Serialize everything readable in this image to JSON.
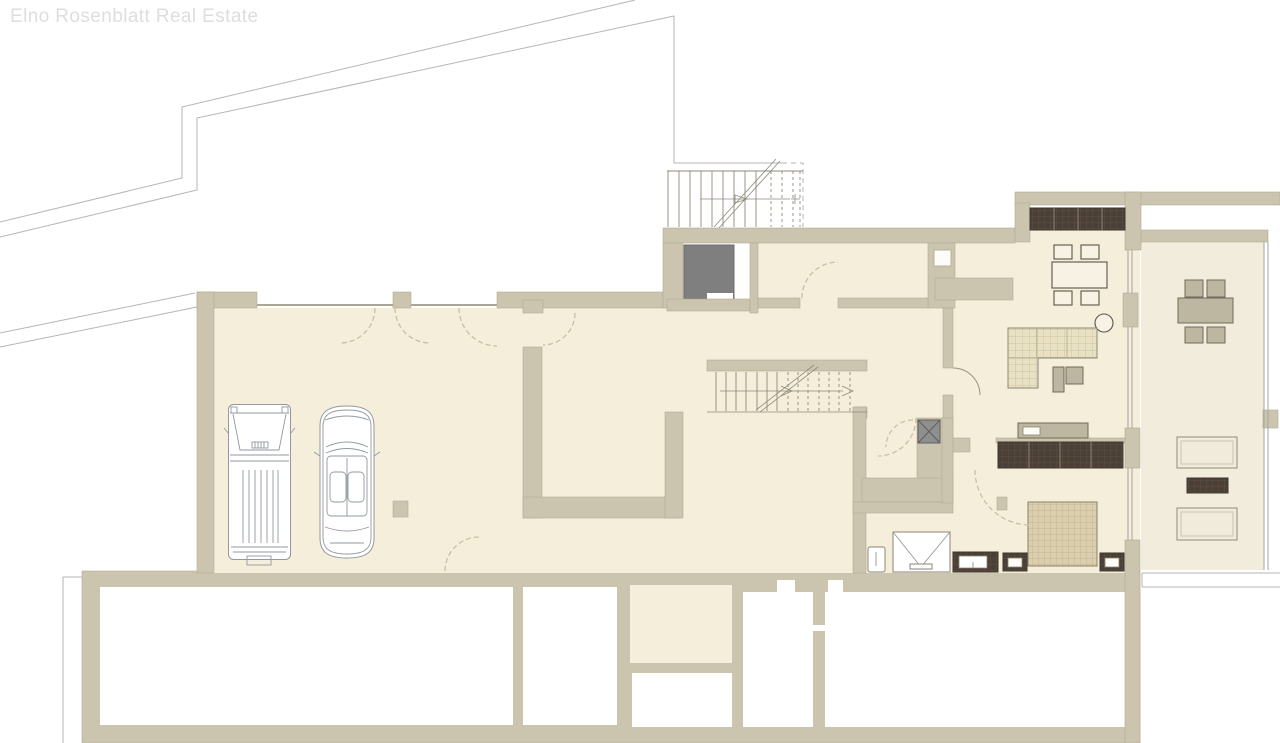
{
  "watermark": {
    "text": "Elno Rosenblatt Real Estate"
  },
  "palette": {
    "wall": "#cbc4ae",
    "wallStroke": "#b2ab95",
    "floor": "#f4eedb",
    "floorEast": "#f1ecdc",
    "outline": "#b5b5b5",
    "stair": "#8f8a7b",
    "dashDoor": "#ccbf9e",
    "darkWood": "#4b4036",
    "darkWoodLine": "#8d8273",
    "grayBox": "#7f7f7f",
    "shaft": "#8f8f8f",
    "shaftLine": "#5f5f5f",
    "sofa": "#e9e1c4",
    "sofaLine": "#cdc2a0",
    "bed": "#dccfae",
    "bedLine": "#c3b592",
    "furnGray": "#bdb6a1",
    "furnGrayLine": "#6f6a5a",
    "furnCream": "#f7f2e3",
    "furnCreamLine": "#5a554a",
    "carLine": "#9299a1",
    "watermark": "#dedede",
    "glass": "#a3a3a3",
    "thinLine": "#ada695"
  },
  "icons": {
    "vehicles": [
      "van",
      "convertible-car"
    ],
    "furniture": [
      "dining-table-with-chairs",
      "round-side-table",
      "corner-sofa",
      "coffee-tables",
      "kitchen-counter",
      "sideboard",
      "wardrobe",
      "double-bed",
      "nightstands",
      "loungers",
      "rug",
      "outdoor-dining-table"
    ],
    "fixtures": [
      "shower",
      "toilet",
      "vanity-basin",
      "elevator-shaft",
      "storage-box",
      "interior-staircase",
      "exterior-staircase",
      "door-swings",
      "windows"
    ]
  }
}
